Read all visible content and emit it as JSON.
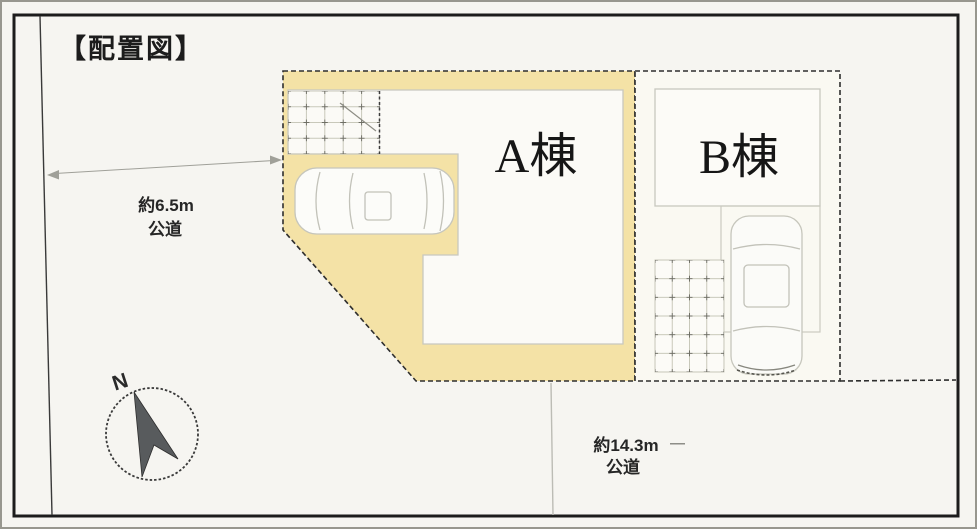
{
  "title": "【配置図】",
  "site_plan": {
    "buildings": [
      {
        "id": "A",
        "label": "A棟"
      },
      {
        "id": "B",
        "label": "B棟"
      }
    ],
    "roads": {
      "west": {
        "width": "約6.5m",
        "type": "公道"
      },
      "south": {
        "width": "約14.3m",
        "dash": "―",
        "type": "公道"
      }
    },
    "compass": {
      "north_label": "N"
    }
  },
  "colors": {
    "highlight": "#f4e2a6",
    "paper": "#f6f5f1",
    "frame": "#1c1c1c",
    "boundary": "#2e2e2e",
    "outline": "#c8c8bf"
  }
}
